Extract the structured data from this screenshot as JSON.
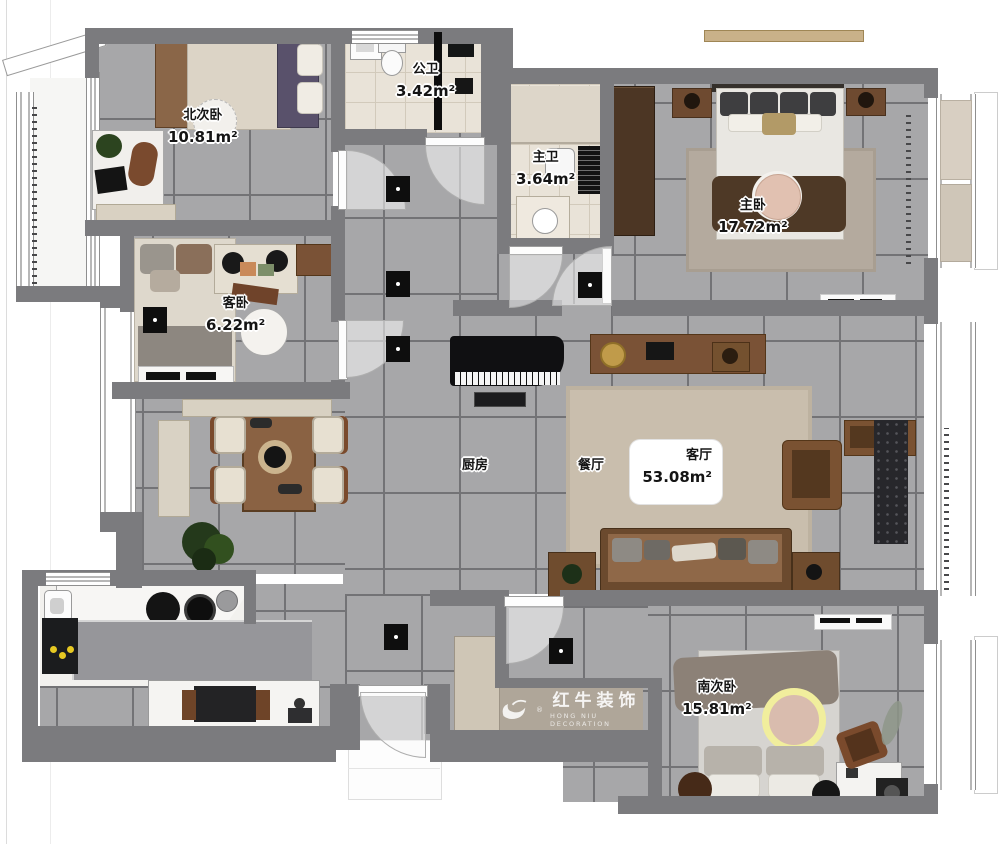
{
  "rooms": {
    "north_bedroom": {
      "name": "北次卧",
      "area": "10.81m²"
    },
    "public_bath": {
      "name": "公卫",
      "area": "3.42m²"
    },
    "master_bath": {
      "name": "主卫",
      "area": "3.64m²"
    },
    "master_bedroom": {
      "name": "主卧",
      "area": "17.72m²"
    },
    "guest_bedroom": {
      "name": "客卧",
      "area": "6.22m²"
    },
    "kitchen": {
      "name": "厨房"
    },
    "dining": {
      "name": "餐厅"
    },
    "living": {
      "name": "客厅",
      "area": "53.08m²"
    },
    "south_bedroom": {
      "name": "南次卧",
      "area": "15.81m²"
    }
  },
  "watermark": {
    "reg": "®",
    "name": "红牛装饰",
    "name_en": "HONG NIU DECORATION"
  }
}
